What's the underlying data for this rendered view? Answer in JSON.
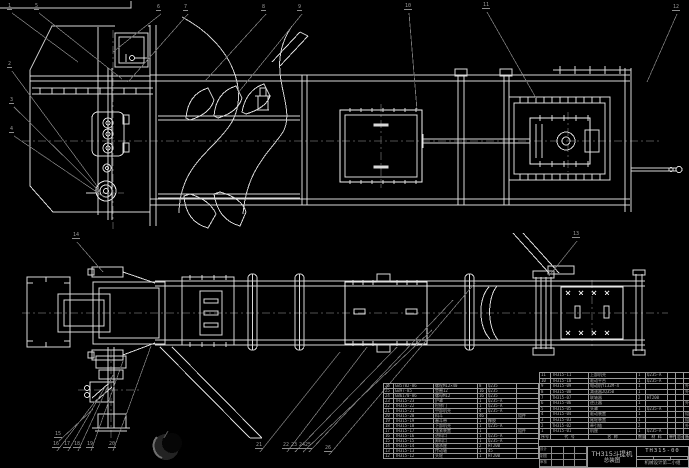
{
  "title_block": {
    "product": "TH315斗提机",
    "drawing_title": "总装图",
    "drawing_no": "TH315-00",
    "org": "机械设计第二小组",
    "signature_labels": [
      "设计",
      "制图",
      "审核"
    ]
  },
  "bom_right": {
    "headers": [
      "序号",
      "代 号",
      "名 称",
      "数量",
      "材 料",
      "单件",
      "总计",
      "备注"
    ],
    "rows": [
      [
        "11",
        "TH315-11",
        "上部机壳",
        "1",
        "Q235-A",
        "",
        "",
        ""
      ],
      [
        "10",
        "TH315-10",
        "驱动平台",
        "1",
        "Q235-A",
        "",
        "",
        ""
      ],
      [
        "9",
        "TH315-09",
        "电动机Y132M-4",
        "1",
        "",
        "",
        "",
        "外购"
      ],
      [
        "8",
        "TH315-08",
        "减速器ZQ350",
        "1",
        "",
        "",
        "",
        "外购"
      ],
      [
        "7",
        "TH315-07",
        "联轴器",
        "2",
        "HT200",
        "",
        "",
        ""
      ],
      [
        "6",
        "TH315-06",
        "逆止器",
        "1",
        "",
        "",
        "",
        "外购"
      ],
      [
        "5",
        "TH315-05",
        "头罩",
        "1",
        "Q235-A",
        "",
        "",
        ""
      ],
      [
        "4",
        "TH315-04",
        "驱动装置",
        "1",
        "",
        "",
        "",
        "组件"
      ],
      [
        "3",
        "TH315-03",
        "尾轮装置",
        "1",
        "",
        "",
        "",
        "组件"
      ],
      [
        "2",
        "TH315-02",
        "牵引链",
        "2",
        "",
        "",
        "",
        "外购"
      ],
      [
        "1",
        "TH315-01",
        "机座",
        "1",
        "Q235-A",
        "",
        "",
        ""
      ]
    ]
  },
  "bom_left": {
    "rows": [
      [
        "26",
        "GB5782-86",
        "螺栓M12×40",
        "8",
        "Q235",
        ""
      ],
      [
        "25",
        "GB97-85",
        "垫圈12",
        "16",
        "Q235",
        ""
      ],
      [
        "24",
        "GB6170-86",
        "螺母M12",
        "16",
        "Q235",
        ""
      ],
      [
        "23",
        "TH315-23",
        "护罩",
        "1",
        "Q235-A",
        ""
      ],
      [
        "22",
        "TH315-22",
        "检修门",
        "1",
        "Q235-A",
        ""
      ],
      [
        "21",
        "TH315-21",
        "中部机壳",
        "4",
        "Q235-A",
        ""
      ],
      [
        "20",
        "TH315-20",
        "料斗",
        "46",
        "",
        "组件"
      ],
      [
        "19",
        "TH315-19",
        "畚斗带",
        "1",
        "橡胶",
        ""
      ],
      [
        "18",
        "TH315-18",
        "下部机壳",
        "1",
        "Q235-A",
        ""
      ],
      [
        "17",
        "TH315-17",
        "张紧装置",
        "1",
        "",
        "组件"
      ],
      [
        "16",
        "TH315-16",
        "进料口",
        "1",
        "Q235-A",
        ""
      ],
      [
        "15",
        "TH315-15",
        "卸料口",
        "1",
        "Q235-A",
        ""
      ],
      [
        "14",
        "TH315-14",
        "轴承座",
        "2",
        "HT200",
        ""
      ],
      [
        "13",
        "TH315-13",
        "传动轴",
        "1",
        "45",
        ""
      ],
      [
        "12",
        "TH315-12",
        "头轮",
        "1",
        "HT200",
        ""
      ]
    ]
  },
  "callouts": [
    {
      "label": "1",
      "x": 10,
      "y": 9,
      "tx": 78,
      "ty": 62
    },
    {
      "label": "2",
      "x": 10,
      "y": 67,
      "tx": 97,
      "ty": 186
    },
    {
      "label": "3",
      "x": 12,
      "y": 103,
      "tx": 100,
      "ty": 192
    },
    {
      "label": "4",
      "x": 12,
      "y": 132,
      "tx": 104,
      "ty": 197
    },
    {
      "label": "5",
      "x": 37,
      "y": 9,
      "tx": 122,
      "ty": 79
    },
    {
      "label": "6",
      "x": 159,
      "y": 10,
      "tx": 113,
      "ty": 52
    },
    {
      "label": "7",
      "x": 186,
      "y": 10,
      "tx": 128,
      "ty": 82
    },
    {
      "label": "8",
      "x": 264,
      "y": 10,
      "tx": 206,
      "ty": 80
    },
    {
      "label": "9",
      "x": 300,
      "y": 10,
      "tx": 238,
      "ty": 93
    },
    {
      "label": "10",
      "x": 407,
      "y": 9,
      "tx": 417,
      "ty": 110
    },
    {
      "label": "11",
      "x": 485,
      "y": 8,
      "tx": 536,
      "ty": 98
    },
    {
      "label": "12",
      "x": 675,
      "y": 10,
      "tx": 647,
      "ty": 82
    },
    {
      "label": "13",
      "x": 575,
      "y": 237,
      "tx": 549,
      "ty": 276
    },
    {
      "label": "14",
      "x": 75,
      "y": 238,
      "tx": 103,
      "ty": 272
    },
    {
      "label": "15",
      "x": 57,
      "y": 437,
      "tx": 93,
      "ty": 409
    },
    {
      "label": "16",
      "x": 55,
      "y": 447,
      "tx": 97,
      "ty": 399
    },
    {
      "label": "17",
      "x": 66,
      "y": 447,
      "tx": 105,
      "ty": 387
    },
    {
      "label": "18",
      "x": 76,
      "y": 447,
      "tx": 113,
      "ty": 375
    },
    {
      "label": "19",
      "x": 89,
      "y": 447,
      "tx": 123,
      "ty": 361
    },
    {
      "label": "20",
      "x": 111,
      "y": 447,
      "tx": 151,
      "ty": 346
    },
    {
      "label": "21",
      "x": 258,
      "y": 448,
      "tx": 340,
      "ty": 352
    },
    {
      "label": "22",
      "x": 285,
      "y": 448,
      "tx": 367,
      "ty": 347
    },
    {
      "label": "23",
      "x": 293,
      "y": 448,
      "tx": 397,
      "ty": 347
    },
    {
      "label": "24",
      "x": 301,
      "y": 448,
      "tx": 432,
      "ty": 330
    },
    {
      "label": "25",
      "x": 307,
      "y": 448,
      "tx": 453,
      "ty": 300
    },
    {
      "label": "26",
      "x": 327,
      "y": 451,
      "tx": 475,
      "ty": 283
    }
  ],
  "colors": {
    "background": "#000000",
    "line": "#d9d9d9",
    "bright_line": "#f2f2f2",
    "leader": "#787878",
    "centerline": "#4f4f4f",
    "table_text": "#b4b4b4",
    "watermark": "#232323"
  }
}
